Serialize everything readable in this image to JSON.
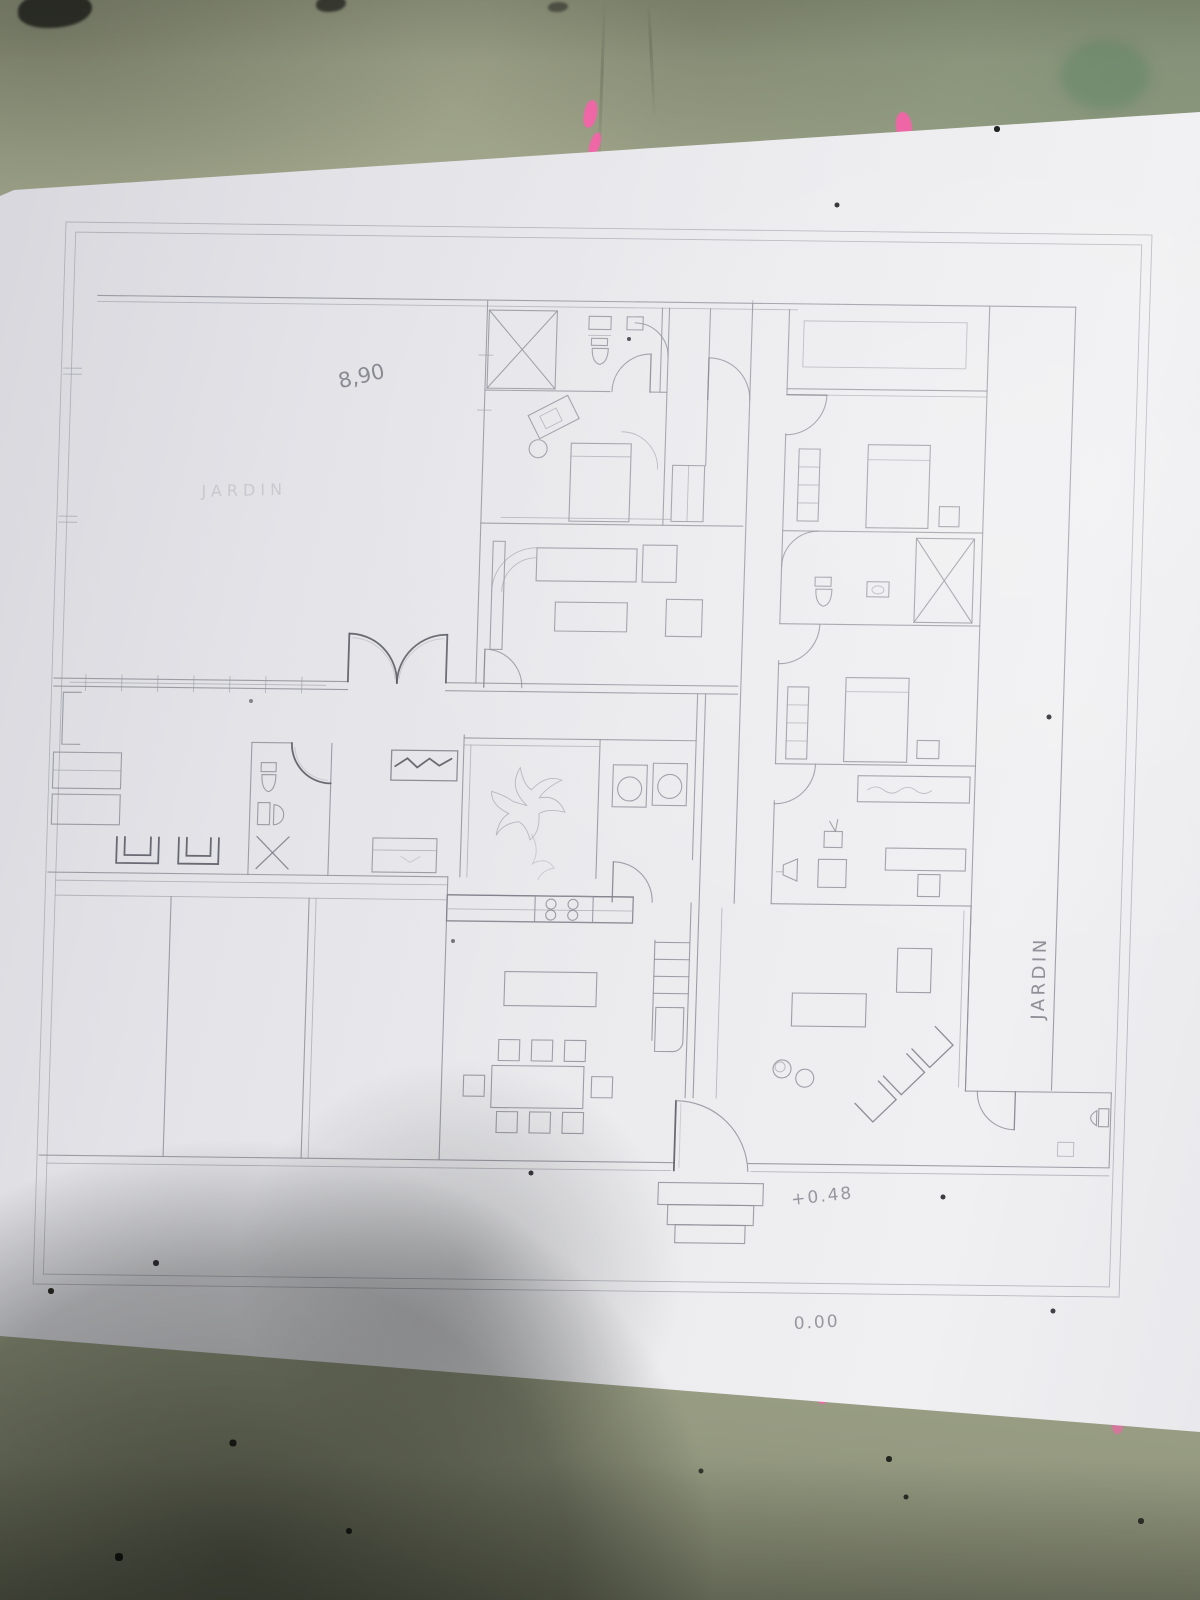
{
  "photo": {
    "annotations": {
      "dimension_top": "8,90",
      "garden_label_faint": "JARDIN",
      "garden_label_side": "JARDIN",
      "level_entrance": "+0.48",
      "level_ground": "0.00"
    },
    "colors": {
      "paper": "#e9e9ed",
      "table_surface": "#a3a88e",
      "pencil_line": "#8f8f99",
      "pencil_dark": "#5c5c66",
      "highlighter_pink": "#ff5ead"
    }
  }
}
